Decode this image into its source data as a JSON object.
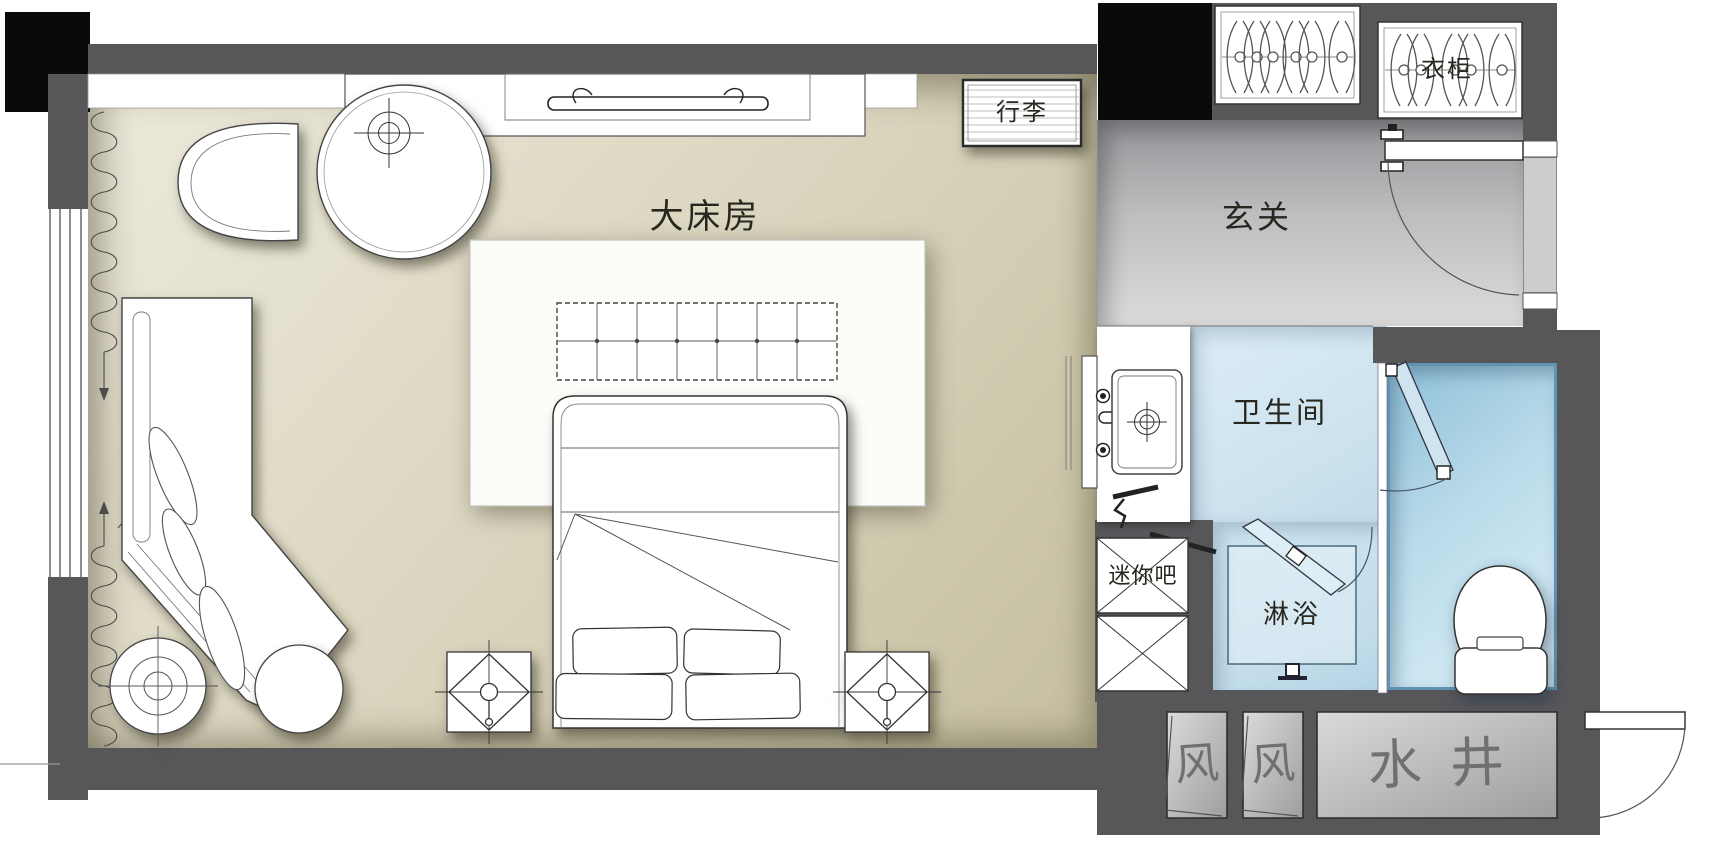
{
  "rooms": {
    "bedroom": "大床房",
    "entry": "玄关",
    "bathroom": "卫生间",
    "shower": "淋浴"
  },
  "fixtures": {
    "luggage": "行李",
    "wardrobe": "衣柜",
    "minibar": "迷你吧",
    "water_shaft": "水井",
    "vent_left": "风",
    "vent_right": "风"
  },
  "colors": {
    "wall": "#57575a",
    "column": "#0a0a0a",
    "line": "#3a3a38",
    "bedroom_floor_light": "#edeadd",
    "bedroom_floor_dark": "#c5be9f",
    "entry_floor_dark": "#96969a",
    "entry_floor_light": "#dcdcdc",
    "bath_floor": "#cee3ef",
    "shower_floor": "#c3ddeb",
    "toilet_floor_dark": "#8fc0d8",
    "toilet_floor_light": "#ddf1f9",
    "toilet_border": "#5f93b4",
    "label": "#27271f",
    "sketch": "#707070"
  }
}
